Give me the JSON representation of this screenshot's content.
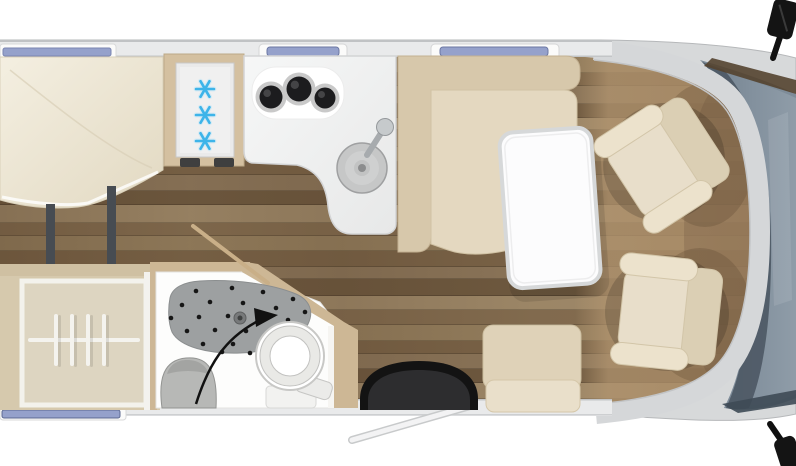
{
  "scene": {
    "description": "Top-down 3D-rendered motorhome interior floor plan",
    "vehicle_front": "right",
    "visible_text": ""
  },
  "colors": {
    "background": "#ffffff",
    "body_shell": "#d7d9da",
    "wall_band": "#e9eaeb",
    "wall_line": "#c3c5c7",
    "windshield": "#7e8c99",
    "windshield_dark": "#4c5864",
    "dash_trim": "#54422f",
    "mirror": "#141414",
    "window_glass": "#95a1cb",
    "window_frame": "#fbfbfa",
    "bed": "#efe8d6",
    "bed_shade": "#e2d9c2",
    "support_bar": "#474c52",
    "cabinet_tan": "#d4c0a0",
    "fridge_panel": "#eaeaea",
    "snowflake": "#3db4e9",
    "counter": "#f2f3f3",
    "burner": "#1c1c1e",
    "sink": "#c6c7c7",
    "sofa_back": "#d7c8ab",
    "sofa_seat": "#e4d8c0",
    "table_top": "#fcfcfd",
    "table_rim": "#d6d8d9",
    "bench_back": "#dfd2b8",
    "bench_seat": "#e9dfca",
    "mat_outer": "#131313",
    "mat_inner": "#2d2d2f",
    "bath_floor": "#fdfdfc",
    "bath_wall": "#cdb795",
    "shower_tray": "#9da0a1",
    "shower_dot": "#161616",
    "basin": "#b7b8b6",
    "toilet": "#ffffff",
    "wardrobe_box": "#ddd5c1",
    "wardrobe_frame": "#f3f2ec",
    "hanger": "#f4f3ee",
    "seat_main": "#e8deca",
    "seat_back": "#dbcfb4",
    "seat_arm": "#ece2cc",
    "seat_edge": "#d2c5a8",
    "cab_floor_tint": "#b1946f",
    "arrow": "#111111",
    "swivel_wall": "#c9af88"
  },
  "floor": {
    "plank_colors": [
      "#96805f",
      "#7b6448",
      "#8d775b",
      "#6f5a40",
      "#a08a6a",
      "#846d50"
    ],
    "plank_heights": [
      16,
      13,
      18,
      14,
      12,
      17,
      15,
      13,
      16,
      14,
      18,
      13,
      15,
      16,
      12,
      17,
      14,
      15,
      16,
      13,
      15,
      14,
      16,
      15
    ]
  },
  "top_wall": {
    "bed_window": {
      "x": 0,
      "y": 44,
      "w": 116,
      "h": 15
    },
    "kitchen_skylight": {
      "x": 259,
      "y": 44,
      "w": 88,
      "h": 15
    },
    "lounge_skylight": {
      "x": 431,
      "y": 44,
      "w": 128,
      "h": 15
    }
  },
  "bottom_wall": {
    "rear_window": {
      "x": 0,
      "y": 406,
      "w": 126,
      "h": 14
    },
    "entry_door_open": true
  },
  "bedroom": {
    "bed_type": "french-bed",
    "support_count": 2
  },
  "fridge": {
    "snowflake_count": 3,
    "snowflake_centers": [
      [
        205,
        89
      ],
      [
        205,
        115
      ],
      [
        205,
        141
      ]
    ],
    "snowflake_radius": 9
  },
  "kitchen": {
    "burner_count": 3,
    "burners": [
      [
        271,
        97,
        11.5
      ],
      [
        299,
        89,
        12.5
      ],
      [
        325,
        98,
        10.5
      ]
    ],
    "sink_center": [
      362,
      168
    ],
    "sink_radius": 25
  },
  "bathroom": {
    "swivel_wall_open": true,
    "drain": [
      240,
      318
    ],
    "shower_dots": [
      [
        196,
        291
      ],
      [
        232,
        288
      ],
      [
        263,
        292
      ],
      [
        293,
        299
      ],
      [
        182,
        305
      ],
      [
        210,
        302
      ],
      [
        243,
        303
      ],
      [
        276,
        308
      ],
      [
        171,
        318
      ],
      [
        199,
        317
      ],
      [
        228,
        316
      ],
      [
        258,
        318
      ],
      [
        288,
        320
      ],
      [
        187,
        331
      ],
      [
        215,
        330
      ],
      [
        246,
        331
      ],
      [
        275,
        333
      ],
      [
        203,
        344
      ],
      [
        233,
        344
      ],
      [
        262,
        345
      ],
      [
        222,
        352
      ],
      [
        250,
        353
      ],
      [
        296,
        334
      ],
      [
        305,
        312
      ]
    ]
  },
  "wardrobe": {
    "hanger_count": 4,
    "hanger_xs": [
      56,
      72,
      88,
      104
    ],
    "rail_y": 338
  },
  "lounge": {
    "sofa": "L-bench",
    "has_table": true,
    "has_side_bench": true,
    "has_entry_mat": true
  },
  "cab": {
    "swivel_seat_count": 2,
    "swivel_seats": [
      {
        "x": 664,
        "y": 162,
        "rot": -33
      },
      {
        "x": 667,
        "y": 313,
        "rot": 6
      }
    ],
    "mirror_count": 2,
    "windshield": true
  }
}
